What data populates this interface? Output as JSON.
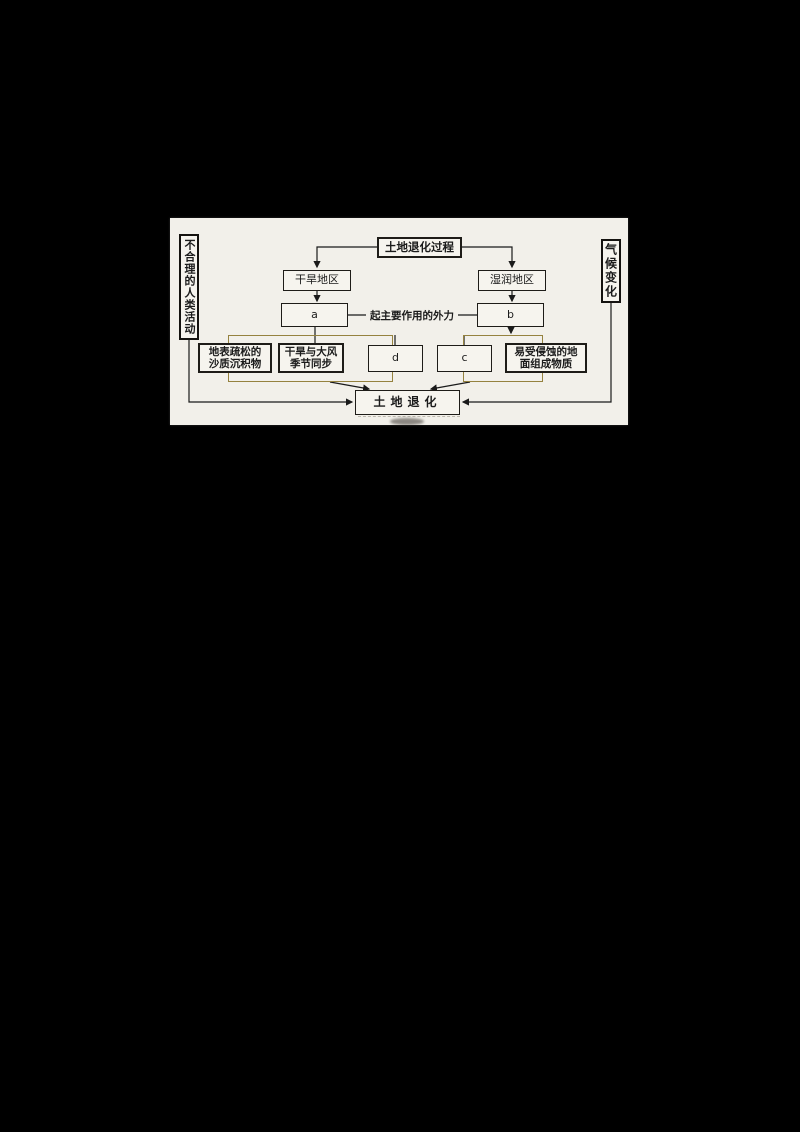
{
  "diagram": {
    "title_box": "土地退化过程",
    "left_sidebar": "不合理的人类活动",
    "right_sidebar": "气候变化",
    "arid_region": "干旱地区",
    "humid_region": "湿润地区",
    "box_a": "a",
    "box_b": "b",
    "box_c": "c",
    "box_d": "d",
    "mid_label": "起主要作用的外力",
    "sandy_line1": "地表疏松的",
    "sandy_line2": "沙质沉积物",
    "wind_line1": "干旱与大风",
    "wind_line2": "季节同步",
    "erosion_line1": "易受侵蚀的地",
    "erosion_line2": "面组成物质",
    "result_box": "土地退化",
    "colors": {
      "panel_background": "#f2f0ea",
      "box_border": "#1e1c18",
      "group_border": "#95823f",
      "line": "#1a1a1a"
    }
  }
}
